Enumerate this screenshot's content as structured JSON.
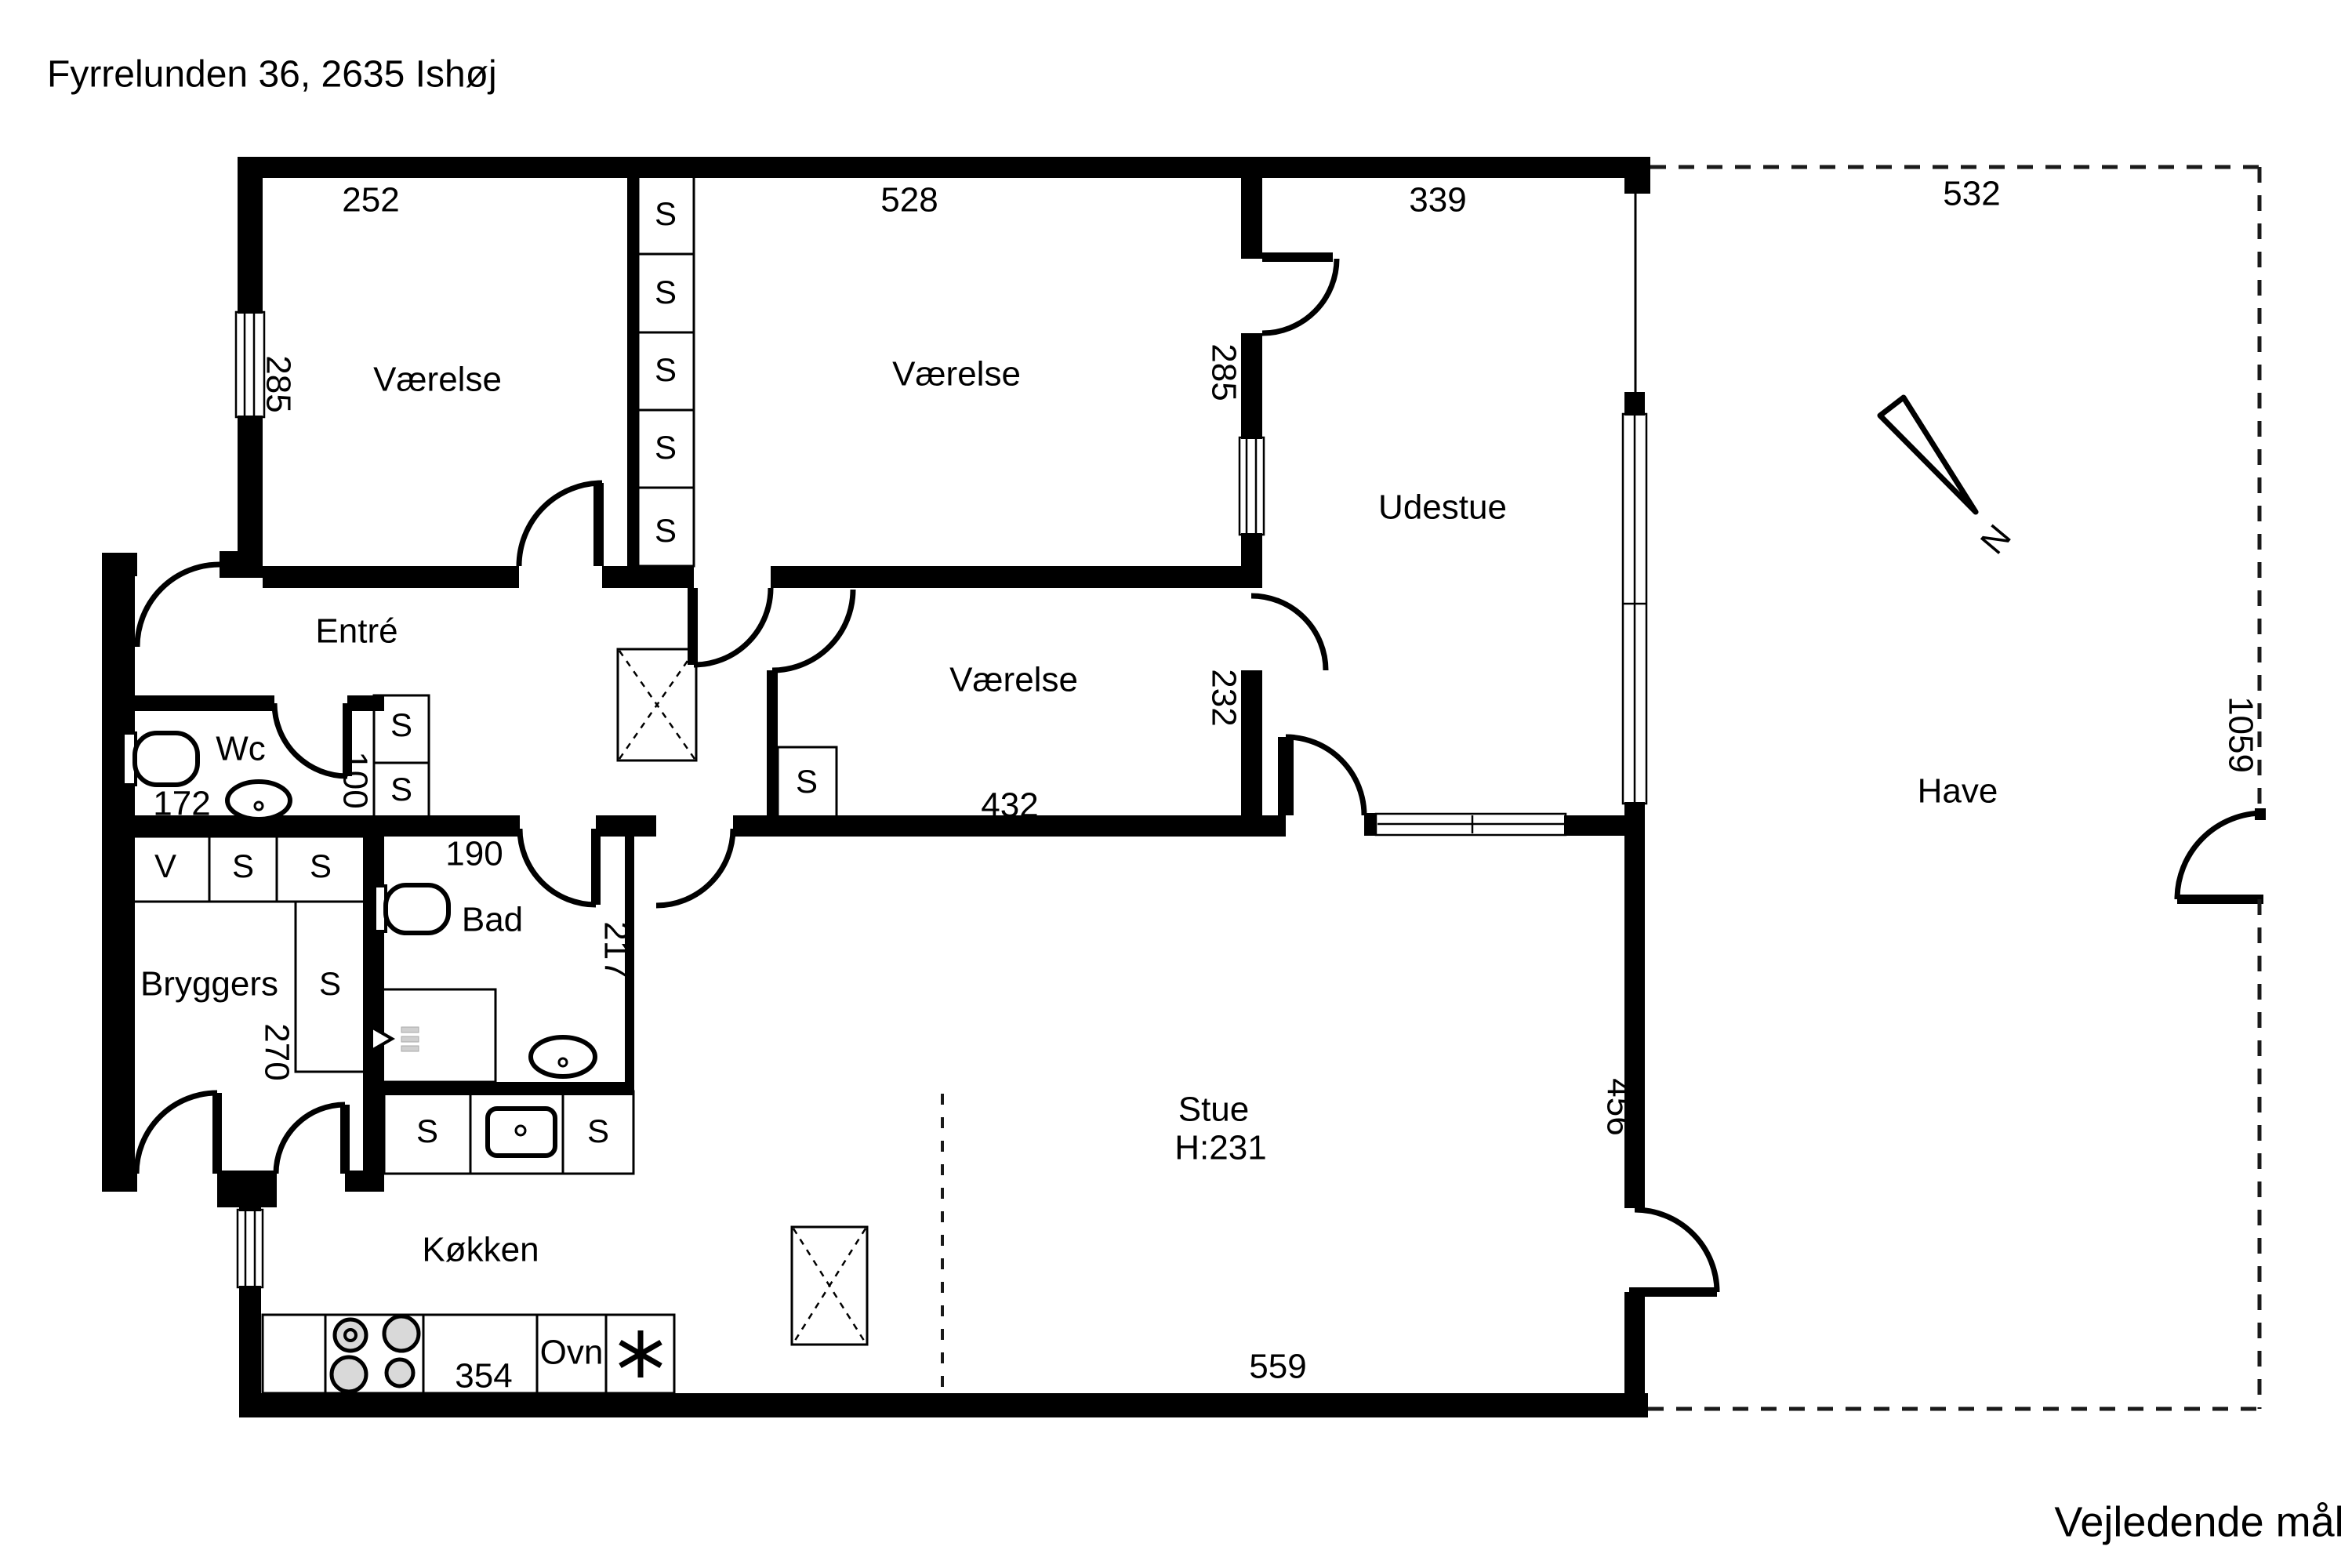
{
  "title": "Fyrrelunden 36, 2635 Ishøj",
  "footer_note": "Vejledende mål",
  "compass": {
    "north_label": "N"
  },
  "rooms": {
    "room_tl": "Værelse",
    "room_top": "Værelse",
    "udestue": "Udestue",
    "entre": "Entré",
    "wc": "Wc",
    "bryggers": "Bryggers",
    "bad": "Bad",
    "koekken": "Køkken",
    "room_mid": "Værelse",
    "stue": "Stue",
    "stue_height": "H:231",
    "have": "Have",
    "ovn": "Ovn"
  },
  "dimensions": {
    "tl_width": "252",
    "top_width": "528",
    "udestue_width": "339",
    "have_width": "532",
    "tl_depth": "285",
    "top_depth": "285",
    "wc_width": "172",
    "wc_depth": "100",
    "bad_width": "190",
    "bad_depth": "217",
    "bryggers_depth": "270",
    "mid_width": "432",
    "mid_depth": "232",
    "koekken_width": "354",
    "stue_width": "559",
    "stue_depth": "456",
    "have_depth": "1059"
  },
  "letters": {
    "closet": "S",
    "washer": "V"
  }
}
